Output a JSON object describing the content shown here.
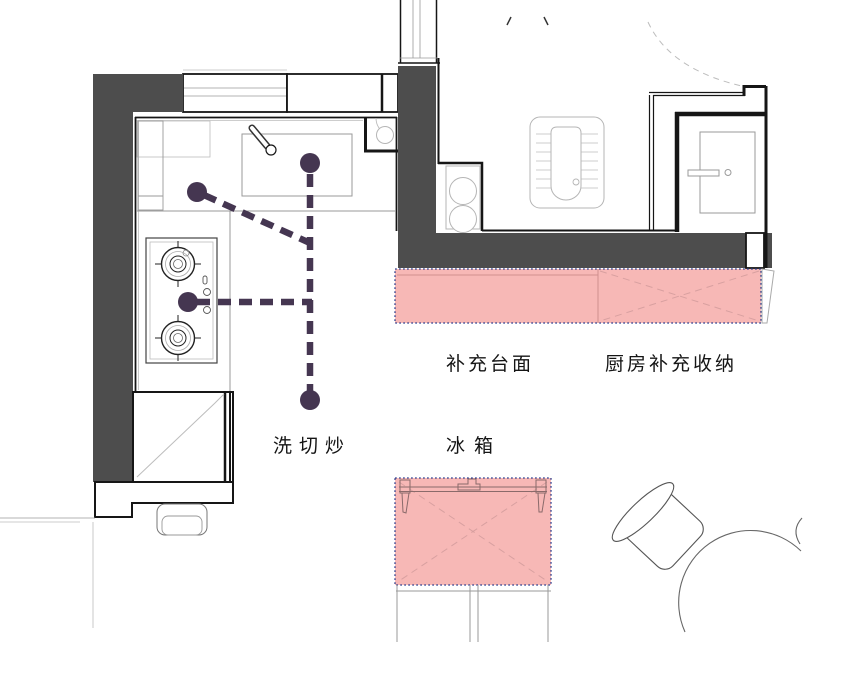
{
  "title": "kitchen-floor-plan",
  "labels": {
    "workflow": "洗切炒",
    "counter_supplement": "补充台面",
    "kitchen_storage": "厨房补充收纳",
    "fridge": "冰箱"
  },
  "colors": {
    "wall": "#4d4d4d",
    "highlight_fill": "#f7b8b6",
    "highlight_border": "#33418f",
    "highlight_line": "#d8a0a0",
    "route": "#453651"
  }
}
